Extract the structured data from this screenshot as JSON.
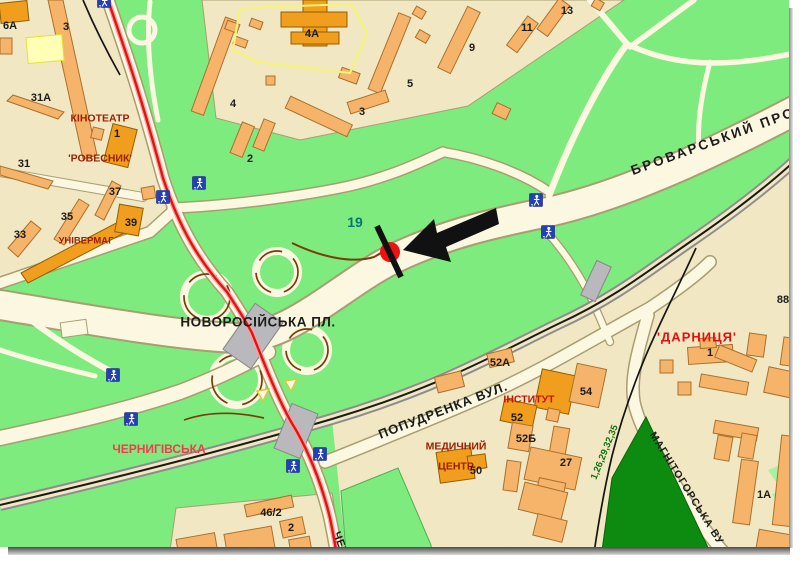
{
  "map": {
    "title_hint": "city map with highlighted billboard location",
    "colors": {
      "background_beige": "#f2e7c3",
      "park_green": "#7eeb7e",
      "forest_dark_green": "#0c8b10",
      "light_green": "#a5f2a0",
      "road_fill": "#fcf7e0",
      "road_edge": "#a79e72",
      "building_fill": "#f5b469",
      "building_stroke": "#a9712c",
      "building_dark": "#f19d1e",
      "yellow_building": "#ffffb5",
      "red_route_line": "#dc1616",
      "railway_black": "#1a1a1a",
      "bridge_gray": "#b9b9bd",
      "pedestrian_icon_blue": "#2540b5",
      "marker_red": "#ee1111",
      "street_label_black": "#1c1c1c",
      "place_label_dark_red": "#9c2000",
      "station_label_red": "#e80e0e",
      "metro_label_red": "#f43a4f",
      "plot_label_teal": "#0a7474",
      "route_numbers_green": "#127512"
    },
    "street_labels": [
      {
        "text": "БРОВАРСЬКИЙ ПРО",
        "x": 713,
        "y": 141,
        "rot": -20,
        "size": 13.5,
        "ls": 2.5
      },
      {
        "text": "НОВОРОСІЙСЬКА ПЛ.",
        "x": 258,
        "y": 322,
        "rot": 0,
        "size": 13.5,
        "ls": 0.5
      },
      {
        "text": "ПОПУДРЕНКА ВУЛ.",
        "x": 443,
        "y": 410,
        "rot": -21,
        "size": 13,
        "ls": 1
      },
      {
        "text": "МАГНІТОГОРСЬКА ВУ",
        "x": 687,
        "y": 488,
        "rot": 58,
        "size": 10.5,
        "ls": 1
      },
      {
        "text": "ЧЕР",
        "x": 341,
        "y": 543,
        "rot": 70,
        "size": 11,
        "ls": 0.5
      }
    ],
    "place_labels": [
      {
        "text": "КІНОТЕАТР",
        "x": 100,
        "y": 118,
        "size": 10.5,
        "color": "#9c2000"
      },
      {
        "text": "'РОВЕСНИК'",
        "x": 100,
        "y": 158,
        "size": 10.5,
        "color": "#9c2000"
      },
      {
        "text": "УНІВЕРМАГ",
        "x": 86,
        "y": 240,
        "size": 9.5,
        "color": "#9c2000"
      },
      {
        "text": "'ДАРНИЦЯ'",
        "x": 697,
        "y": 337,
        "size": 13,
        "color": "#e80e0e",
        "ls": 1
      },
      {
        "text": "ІНСТИТУТ",
        "x": 529,
        "y": 399,
        "size": 10.5,
        "color": "#cc1000"
      },
      {
        "text": "МЕДИЧНИЙ",
        "x": 456,
        "y": 446,
        "size": 10.5,
        "color": "#9c2000"
      },
      {
        "text": "ЦЕНТР",
        "x": 456,
        "y": 466,
        "size": 10.5,
        "color": "#9c2000"
      },
      {
        "text": "ЧЕРНИГІВСЬКА",
        "x": 159,
        "y": 449,
        "size": 12,
        "color": "#f43a4f"
      }
    ],
    "building_numbers": [
      {
        "text": "6А",
        "x": 10,
        "y": 25
      },
      {
        "text": "3",
        "x": 66,
        "y": 26
      },
      {
        "text": "31А",
        "x": 41,
        "y": 97
      },
      {
        "text": "1",
        "x": 117,
        "y": 133
      },
      {
        "text": "31",
        "x": 24,
        "y": 163
      },
      {
        "text": "33",
        "x": 20,
        "y": 234
      },
      {
        "text": "35",
        "x": 67,
        "y": 216
      },
      {
        "text": "37",
        "x": 115,
        "y": 191
      },
      {
        "text": "39",
        "x": 131,
        "y": 222
      },
      {
        "text": "4",
        "x": 233,
        "y": 103
      },
      {
        "text": "4А",
        "x": 312,
        "y": 33
      },
      {
        "text": "2",
        "x": 250,
        "y": 158
      },
      {
        "text": "3",
        "x": 362,
        "y": 111
      },
      {
        "text": "5",
        "x": 410,
        "y": 83
      },
      {
        "text": "9",
        "x": 472,
        "y": 47
      },
      {
        "text": "11",
        "x": 527,
        "y": 27
      },
      {
        "text": "13",
        "x": 567,
        "y": 10
      },
      {
        "text": "19",
        "x": 355,
        "y": 222,
        "color": "#0a7474",
        "size": 14
      },
      {
        "text": "88",
        "x": 783,
        "y": 299
      },
      {
        "text": "1",
        "x": 710,
        "y": 352
      },
      {
        "text": "52А",
        "x": 500,
        "y": 362
      },
      {
        "text": "54",
        "x": 586,
        "y": 391
      },
      {
        "text": "52",
        "x": 517,
        "y": 417
      },
      {
        "text": "52Б",
        "x": 526,
        "y": 438
      },
      {
        "text": "27",
        "x": 566,
        "y": 462
      },
      {
        "text": "50",
        "x": 476,
        "y": 470
      },
      {
        "text": "46/2",
        "x": 271,
        "y": 512
      },
      {
        "text": "2",
        "x": 291,
        "y": 527
      },
      {
        "text": "1А",
        "x": 764,
        "y": 494
      }
    ],
    "route_numbers": {
      "text": "1,26,29,32,35",
      "x": 604,
      "y": 452,
      "rot": -68,
      "size": 9.5,
      "color": "#127512"
    },
    "pedestrian_icons": [
      [
        104,
        1
      ],
      [
        163,
        197
      ],
      [
        199,
        183
      ],
      [
        536,
        200
      ],
      [
        548,
        232
      ],
      [
        113,
        375
      ],
      [
        131,
        419
      ],
      [
        293,
        466
      ],
      [
        320,
        454
      ]
    ],
    "marker": {
      "x": 390,
      "y": 252
    }
  }
}
